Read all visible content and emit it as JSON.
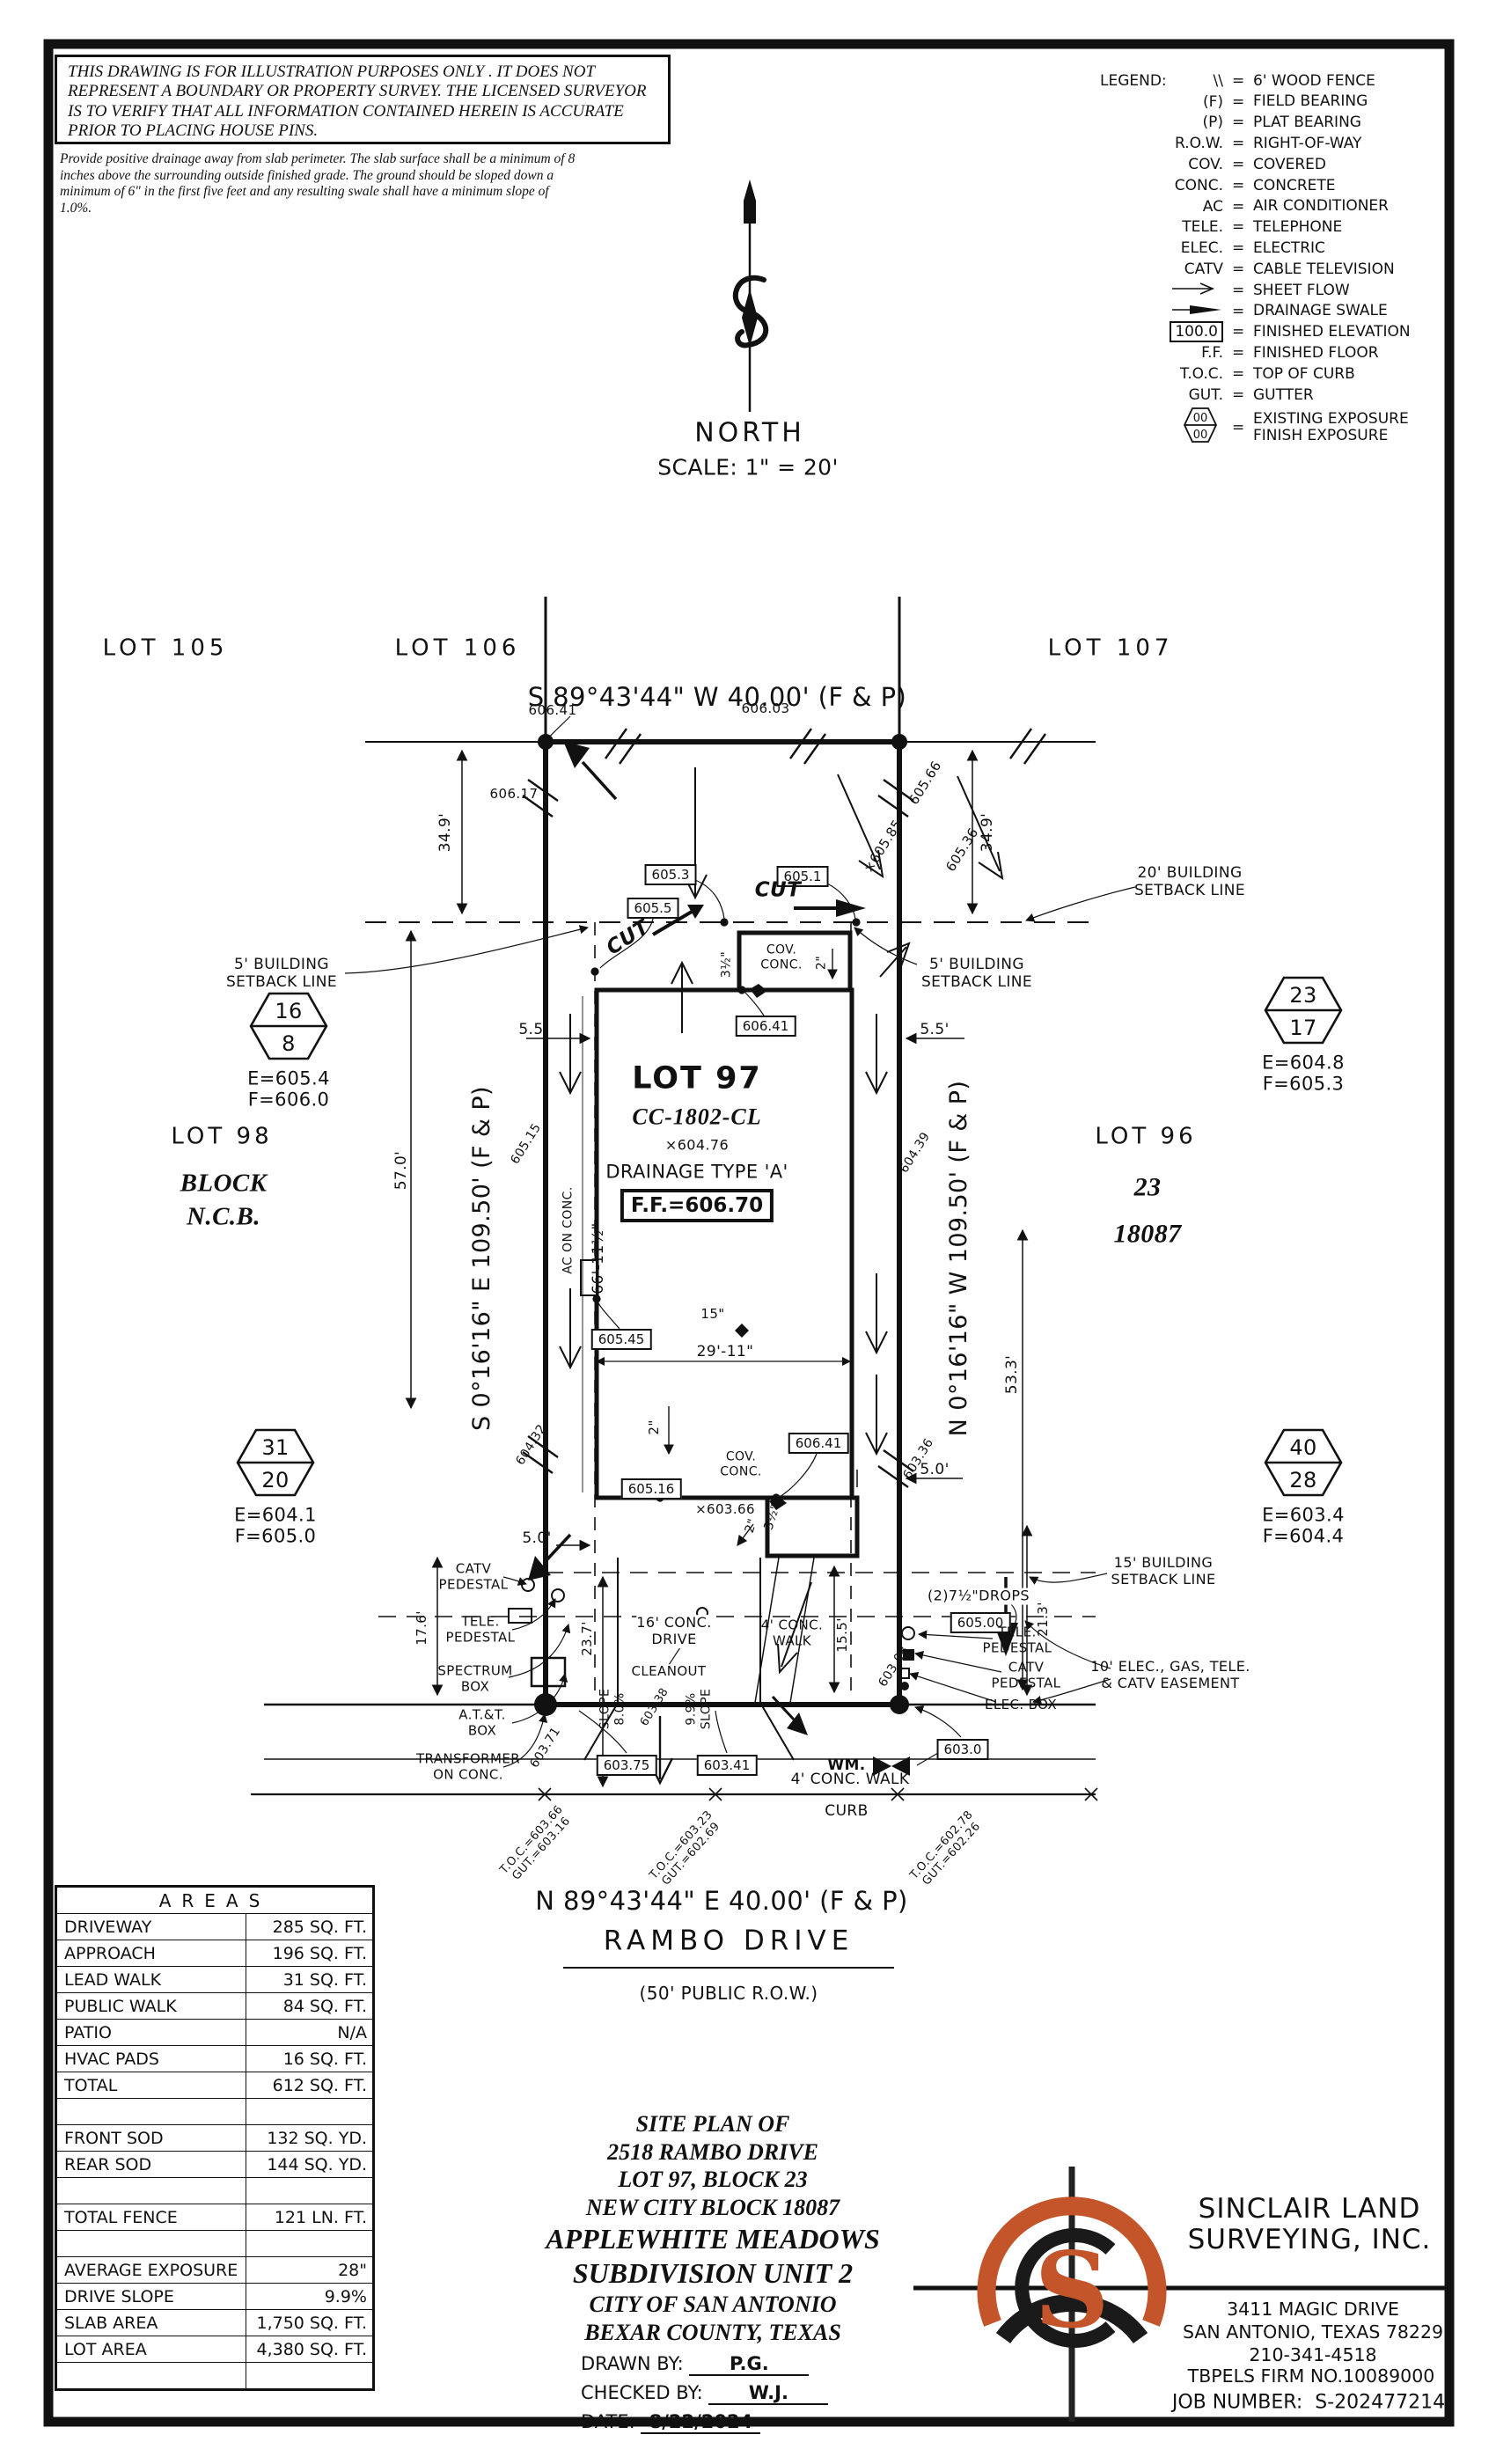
{
  "colors": {
    "ink": "#111111",
    "accent": "#c4552a"
  },
  "disclaimer": {
    "caps": "THIS DRAWING IS FOR ILLUSTRATION PURPOSES ONLY . IT DOES NOT REPRESENT A BOUNDARY OR PROPERTY SURVEY. THE LICENSED SURVEYOR IS TO VERIFY THAT ALL INFORMATION CONTAINED HEREIN IS ACCURATE PRIOR TO PLACING HOUSE PINS.",
    "note": "Provide positive drainage away from slab perimeter. The slab surface shall be a minimum of 8 inches above the surrounding outside finished grade. The ground should be sloped down a minimum of 6\" in the first five feet and any resulting swale shall have a minimum slope of 1.0%."
  },
  "north": {
    "label": "NORTH",
    "scale": "SCALE:  1\" = 20'"
  },
  "legend": {
    "title": "LEGEND:",
    "eq": "=",
    "box_sample": "100.0",
    "exposure_top": "00",
    "exposure_bottom": "00",
    "rows": [
      {
        "sym": "\\\\",
        "desc": "6' WOOD FENCE"
      },
      {
        "sym": "(F)",
        "desc": "FIELD BEARING"
      },
      {
        "sym": "(P)",
        "desc": "PLAT BEARING"
      },
      {
        "sym": "R.O.W.",
        "desc": "RIGHT-OF-WAY"
      },
      {
        "sym": "COV.",
        "desc": "COVERED"
      },
      {
        "sym": "CONC.",
        "desc": "CONCRETE"
      },
      {
        "sym": "AC",
        "desc": "AIR CONDITIONER"
      },
      {
        "sym": "TELE.",
        "desc": "TELEPHONE"
      },
      {
        "sym": "ELEC.",
        "desc": "ELECTRIC"
      },
      {
        "sym": "CATV",
        "desc": "CABLE TELEVISION"
      },
      {
        "sym": "",
        "desc": "SHEET FLOW"
      },
      {
        "sym": "",
        "desc": "DRAINAGE SWALE"
      },
      {
        "sym": "",
        "desc": "FINISHED ELEVATION"
      },
      {
        "sym": "F.F.",
        "desc": "FINISHED FLOOR"
      },
      {
        "sym": "T.O.C.",
        "desc": "TOP OF CURB"
      },
      {
        "sym": "GUT.",
        "desc": "GUTTER"
      },
      {
        "sym": "",
        "desc": "EXISTING EXPOSURE\nFINISH EXPOSURE"
      }
    ]
  },
  "plan": {
    "lots": {
      "lot105": "LOT 105",
      "lot106": "LOT 106",
      "lot107": "LOT 107",
      "lot98": "LOT 98",
      "block_ncb": "BLOCK\nN.C.B.",
      "lot96": "LOT 96",
      "blk23": "23",
      "ncb18087": "18087",
      "lot97": "LOT 97",
      "model": "CC-1802-CL",
      "drainage": "DRAINAGE TYPE 'A'",
      "ff": "F.F.=606.70"
    },
    "bearings": {
      "top": "S 89°43'44\" W 40.00' (F & P)",
      "bottom": "N 89°43'44\" E 40.00' (F & P)",
      "left": "S 0°16'16\" E 109.50' (F & P)",
      "right": "N 0°16'16\" W 109.50' (F & P)"
    },
    "street": {
      "name": "RAMBO DRIVE",
      "row": "(50' PUBLIC R.O.W.)"
    },
    "notes": {
      "setback20": "20' BUILDING\nSETBACK LINE",
      "setback5l": "5' BUILDING\nSETBACK LINE",
      "setback5r": "5' BUILDING\nSETBACK LINE",
      "setback15": "15' BUILDING\nSETBACK LINE",
      "easement10": "10' ELEC., GAS, TELE.\n& CATV EASEMENT",
      "cov_top": "COV.\nCONC.",
      "cov_bot": "COV.\nCONC.",
      "ac": "AC ON CONC.",
      "catv_ped": "CATV\nPEDESTAL",
      "tele_ped": "TELE.\nPEDESTAL",
      "spectrum": "SPECTRUM\nBOX",
      "att": "A.T.&T.\nBOX",
      "transformer": "TRANSFORMER\nON CONC.",
      "tele_ped_r": "TELE.\nPEDESTAL",
      "catv_ped_r": "CATV\nPEDESTAL",
      "elec_box": "ELEC. BOX",
      "drops": "(2)7½\"DROPS",
      "wm": "WM.",
      "drive": "16' CONC.\nDRIVE",
      "cleanout": "CLEANOUT",
      "slope_a": "SLOPE\n8.0%",
      "slope_b": "9.9%\nSLOPE",
      "walk_a": "4' CONC.\nWALK",
      "walk_b": "4' CONC. WALK",
      "curb": "CURB",
      "cut_a": "CUT",
      "cut_b": "CUT"
    },
    "dims": {
      "a34l": "34.9'",
      "a34r": "34.9'",
      "a57": "57.0'",
      "a53": "53.3'",
      "a55l": "5.5'",
      "a55r": "5.5'",
      "a66": "66'-11½\"",
      "a29": "29'-11\"",
      "a15in": "15\"",
      "a2a": "2\"",
      "a2b": "2\"",
      "a2c": "2\"",
      "a3a": "3½\"",
      "a3b": "3½\"",
      "a50l": "5.0'",
      "a50r": "5.0'",
      "a17": "17.6'",
      "a23": "23.7'",
      "a21": "21.3'",
      "a155": "15.5'"
    },
    "boxes": {
      "b605_5": "605.5",
      "b605_3": "605.3",
      "b605_1": "605.1",
      "b606_41a": "606.41",
      "b606_41b": "606.41",
      "b605_45": "605.45",
      "b605_16": "605.16",
      "b605_00": "605.00",
      "b603_75": "603.75",
      "b603_41": "603.41",
      "b603_0": "603.0"
    },
    "spots": {
      "s606_41": "606.41",
      "s606_03": "606.03",
      "s606_17": "606.17",
      "s605_85": "×605.85",
      "s605_66": "605.66",
      "s605_36": "605.36",
      "s605_15": "605.15",
      "s604_39": "604.39",
      "s604_32": "604.32",
      "s603_36": "603.36",
      "s603_08": "603.08",
      "s603_71": "603.71",
      "s603_66": "×603.66",
      "s603_38": "603.38",
      "s604_76": "×604.76"
    },
    "toc": {
      "l": "T.O.C.=603.66\nGUT.=603.16",
      "c": "T.O.C.=603.23\nGUT.=602.69",
      "r": "T.O.C.=602.78\nGUT.=602.26"
    },
    "hex": {
      "h1": {
        "top": "16",
        "bot": "8",
        "e": "E=605.4",
        "f": "F=606.0"
      },
      "h2": {
        "top": "23",
        "bot": "17",
        "e": "E=604.8",
        "f": "F=605.3"
      },
      "h3": {
        "top": "31",
        "bot": "20",
        "e": "E=604.1",
        "f": "F=605.0"
      },
      "h4": {
        "top": "40",
        "bot": "28",
        "e": "E=603.4",
        "f": "F=604.4"
      }
    }
  },
  "areas": {
    "title": "AREAS",
    "rows": [
      {
        "label": "DRIVEWAY",
        "value": "285 SQ. FT."
      },
      {
        "label": "APPROACH",
        "value": "196 SQ. FT."
      },
      {
        "label": "LEAD WALK",
        "value": "31 SQ. FT."
      },
      {
        "label": "PUBLIC WALK",
        "value": "84 SQ. FT."
      },
      {
        "label": "PATIO",
        "value": "N/A"
      },
      {
        "label": "HVAC PADS",
        "value": "16 SQ. FT."
      },
      {
        "label": "TOTAL",
        "value": "612 SQ. FT."
      },
      {
        "label": "",
        "value": ""
      },
      {
        "label": "FRONT SOD",
        "value": "132 SQ. YD."
      },
      {
        "label": "REAR SOD",
        "value": "144 SQ. YD."
      },
      {
        "label": "",
        "value": ""
      },
      {
        "label": "TOTAL FENCE",
        "value": "121 LN. FT."
      },
      {
        "label": "",
        "value": ""
      },
      {
        "label": "AVERAGE EXPOSURE",
        "value": "28\""
      },
      {
        "label": "DRIVE SLOPE",
        "value": "9.9%"
      },
      {
        "label": "SLAB AREA",
        "value": "1,750 SQ. FT."
      },
      {
        "label": "LOT AREA",
        "value": "4,380 SQ. FT."
      },
      {
        "label": "",
        "value": ""
      }
    ]
  },
  "title_block": {
    "lines": [
      "SITE PLAN OF",
      "2518 RAMBO DRIVE",
      "LOT 97, BLOCK 23",
      "NEW CITY BLOCK 18087",
      "APPLEWHITE MEADOWS",
      "SUBDIVISION UNIT 2",
      "CITY OF SAN ANTONIO",
      "BEXAR COUNTY, TEXAS"
    ],
    "drawn_label": "DRAWN BY:",
    "drawn": "P.G.",
    "checked_label": "CHECKED BY:",
    "checked": "W.J.",
    "date_label": "DATE:",
    "date": "8/22/2024"
  },
  "firm": {
    "name1": "SINCLAIR LAND",
    "name2": "SURVEYING, INC.",
    "addr1": "3411 MAGIC DRIVE",
    "addr2": "SAN ANTONIO, TEXAS 78229",
    "phone": "210-341-4518",
    "tbpels": "TBPELS FIRM NO.10089000",
    "job_label": "JOB NUMBER:",
    "job": "S-202477214",
    "logo_letter": "S"
  }
}
